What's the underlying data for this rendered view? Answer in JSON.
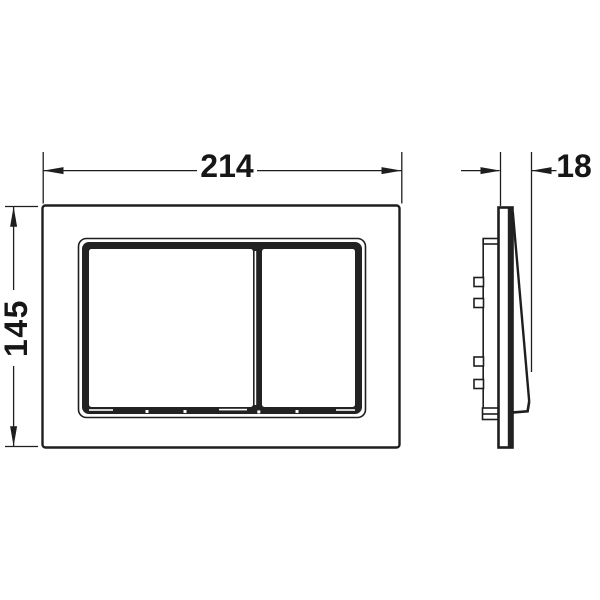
{
  "drawing": {
    "background_color": "#ffffff",
    "line_color": "#1e1e1e",
    "dimensions": {
      "width_label": "214",
      "height_label": "145",
      "depth_label": "18"
    }
  }
}
